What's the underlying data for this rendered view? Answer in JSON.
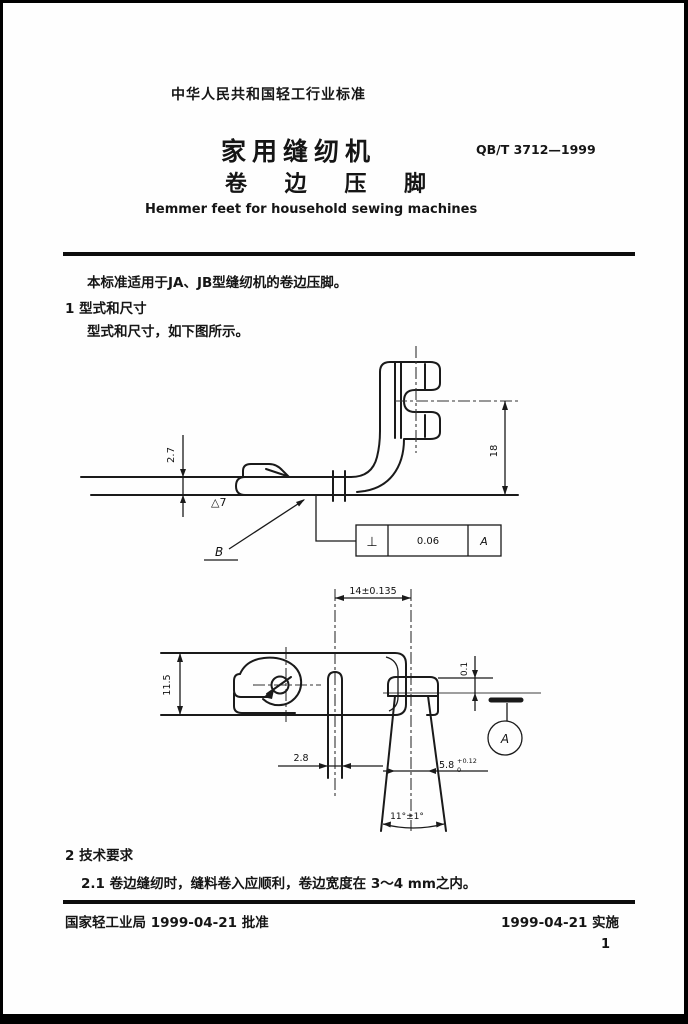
{
  "document": {
    "authority_line": "中华人民共和国轻工行业标准",
    "title_cn_1": "家用缝纫机",
    "title_cn_2": "卷 边 压 脚",
    "standard_code": "QB/T 3712—1999",
    "title_en": "Hemmer feet for household sewing machines",
    "scope_text": "本标准适用于JA、JB型缝纫机的卷边压脚。",
    "section1_heading": "1  型式和尺寸",
    "section1_text": "型式和尺寸，如下图所示。",
    "section2_heading": "2  技术要求",
    "section2_text": "2.1  卷边缝纫时，缝料卷入应顺利，卷边宽度在 3～4 mm之内。",
    "footer_left": "国家轻工业局 1999-04-21 批准",
    "footer_right": "1999-04-21 实施",
    "page_number": "1"
  },
  "side_view": {
    "dim_sole_thickness": "2.7",
    "surface_roughness": "△7",
    "datum_b": "B",
    "dim_fork_height": "18",
    "tolerance_frame": {
      "symbol": "⊥",
      "value": "0.06",
      "datum": "A"
    }
  },
  "top_view": {
    "dim_slot_to_toe": "14±0.135",
    "dim_body_width": "11.5",
    "dim_slot_width": "2.8",
    "dim_toe_width": "5.8",
    "dim_toe_tol_upper": "+0.12",
    "dim_toe_tol_lower": "0",
    "dim_plane_offset": "0.1",
    "dim_toe_angle": "11°±1°",
    "datum_a": "A"
  }
}
